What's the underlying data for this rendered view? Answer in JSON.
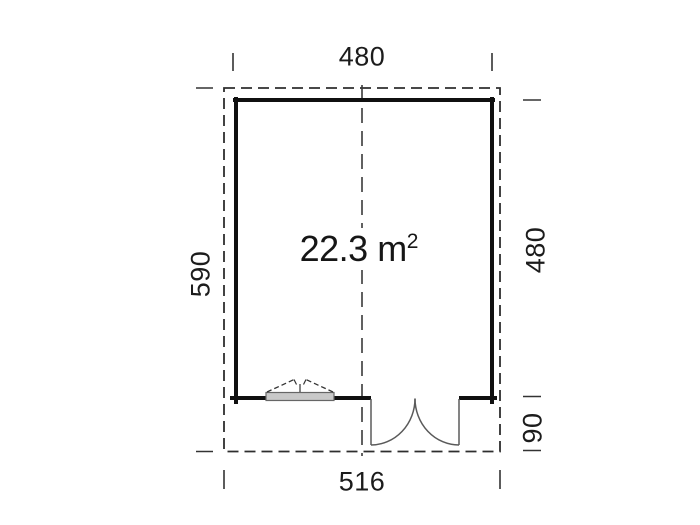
{
  "plan": {
    "area": {
      "text": "22.3 m",
      "sup": "2",
      "full": "22.3 m²"
    },
    "dimensions": {
      "top_width": "480",
      "left_height": "590",
      "right_upper_height": "480",
      "right_lower_height": "90",
      "bottom_width": "516"
    },
    "symbols": [
      "roof-overhang-outline",
      "center-line",
      "walls",
      "tilt-window",
      "double-door"
    ]
  },
  "colors": {
    "background": "#ffffff",
    "wall_line": "#101010",
    "dashed_line": "#2e2e2e",
    "thin_symbol_line": "#5a5a5a",
    "window_fill": "#c9c9c9",
    "text": "#1a1a1a"
  }
}
